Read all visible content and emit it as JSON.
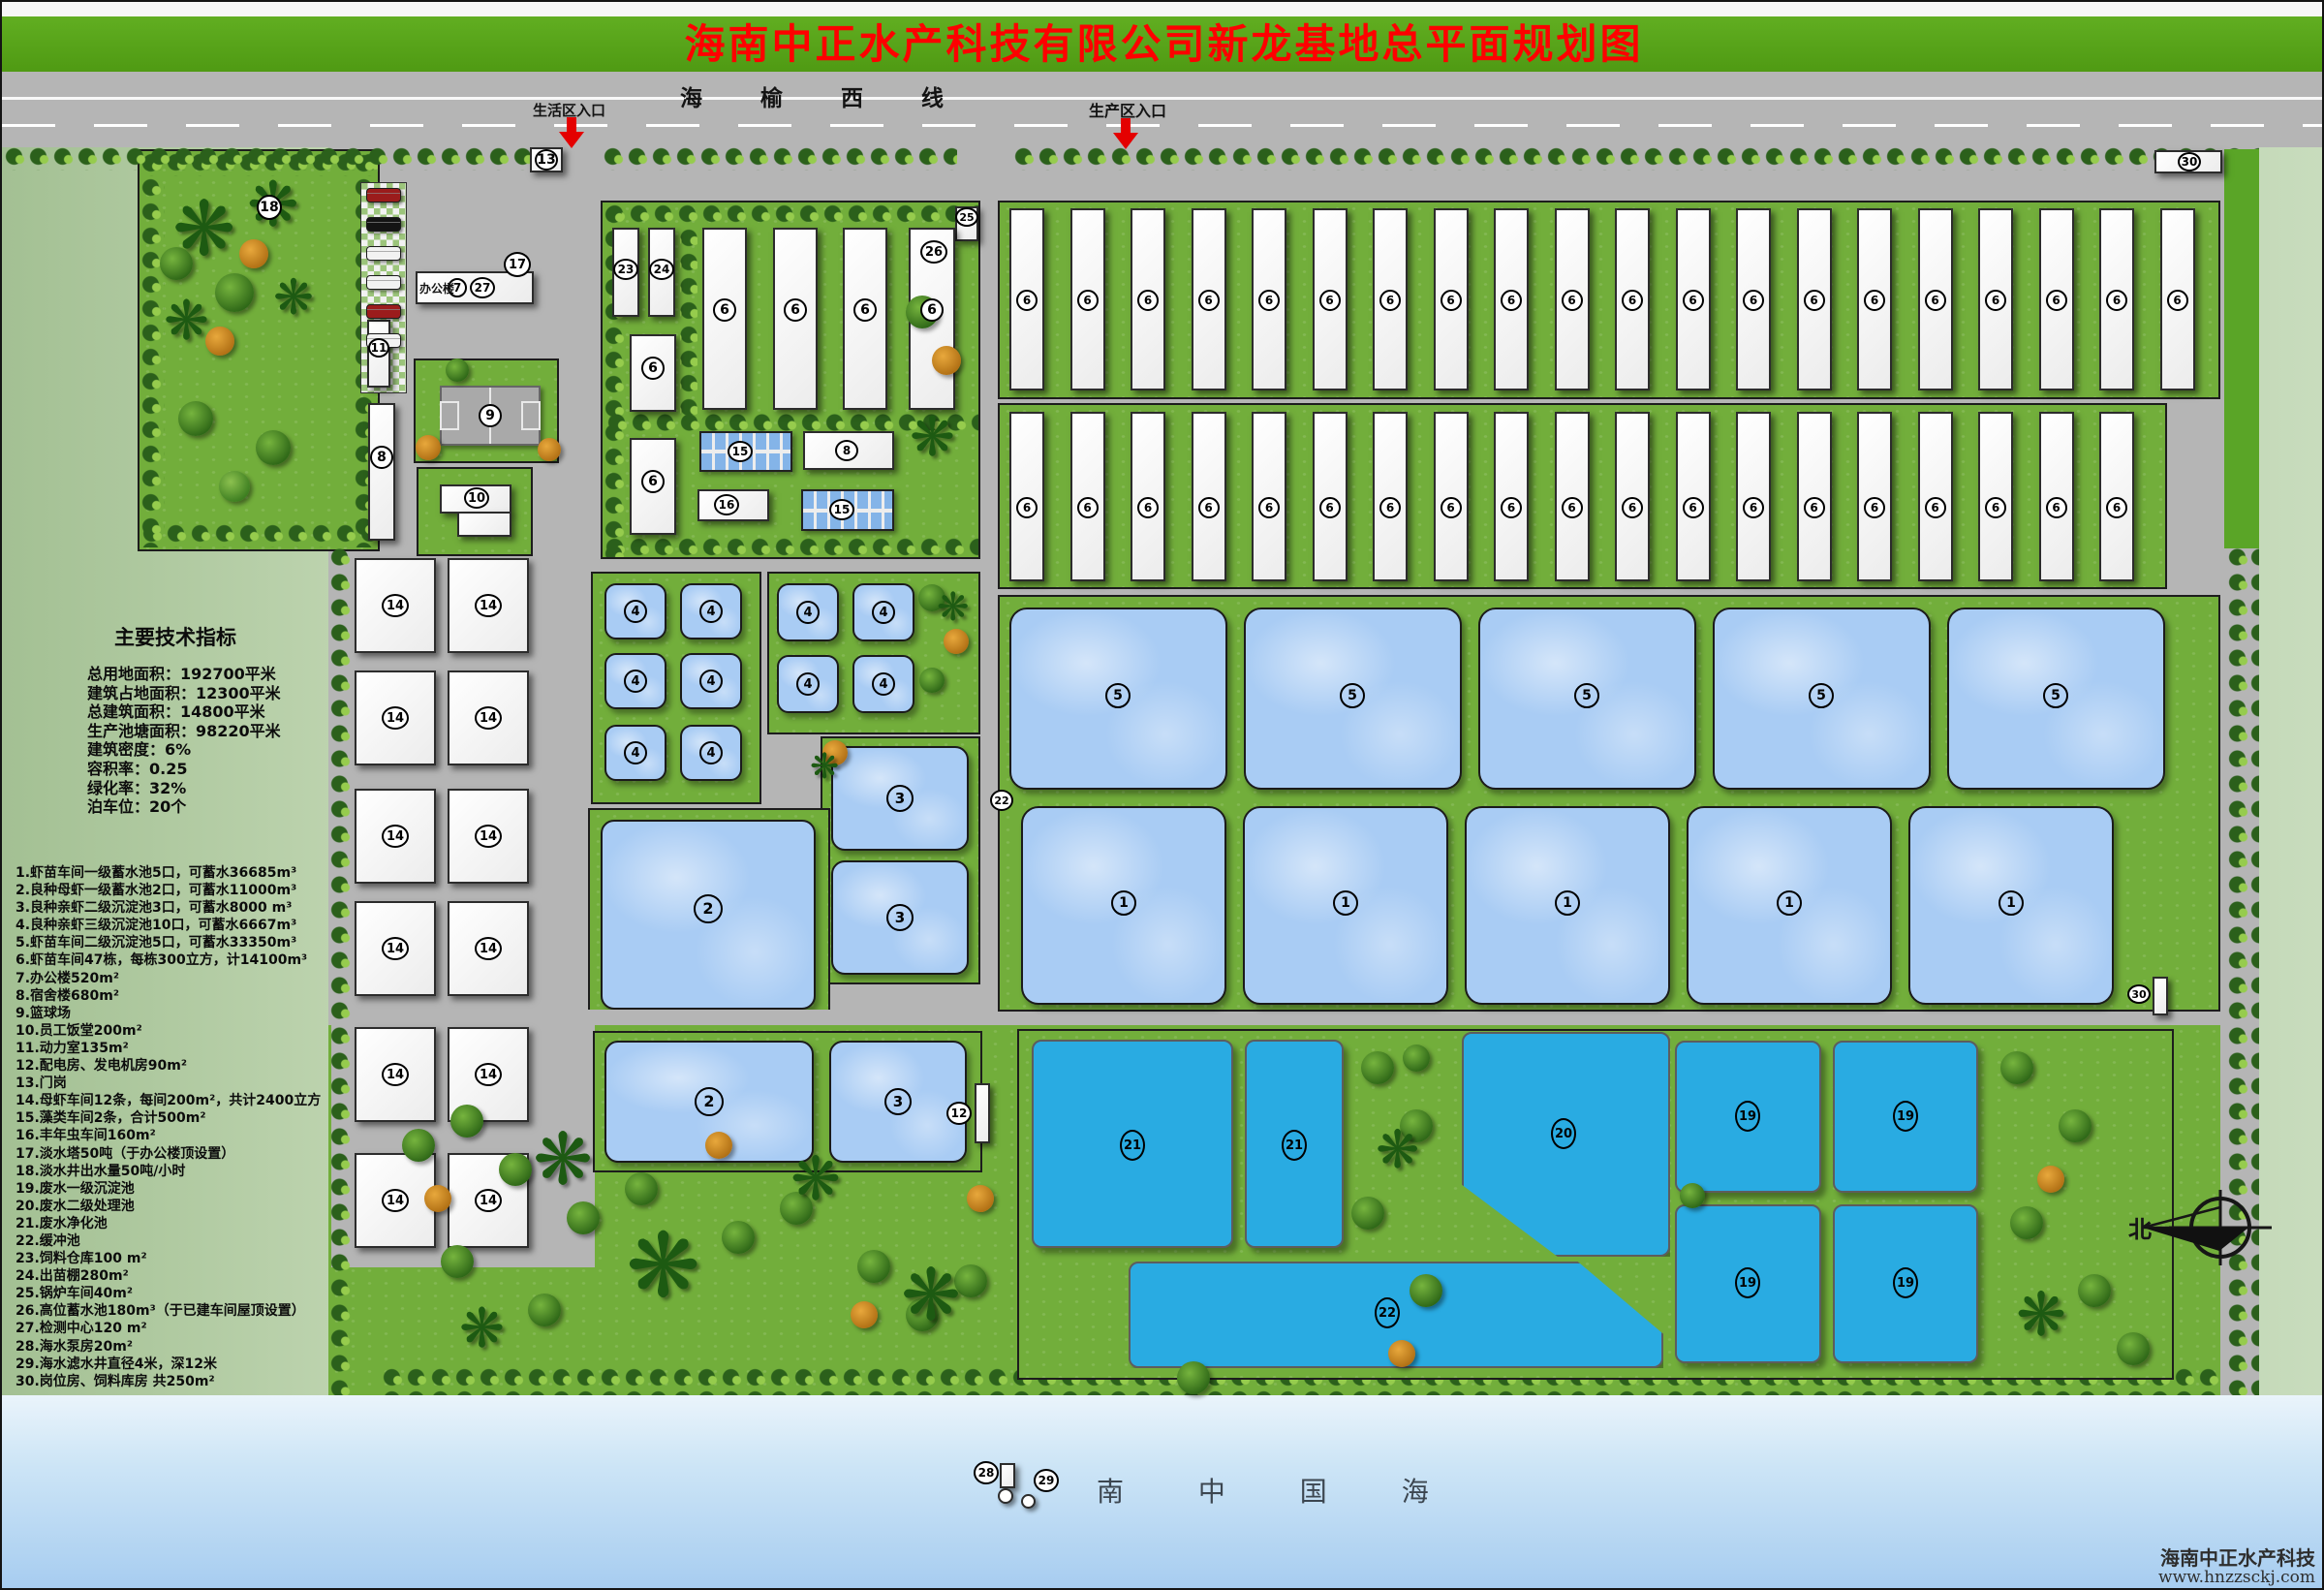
{
  "title": "海南中正水产科技有限公司新龙基地总平面规划图",
  "road": {
    "name": "海 榆 西 线",
    "entrance_residential": "生活区入口",
    "entrance_production": "生产区入口"
  },
  "indicators": {
    "heading": "主要技术指标",
    "lines": [
      "总用地面积：192700平米",
      "建筑占地面积：12300平米",
      "总建筑面积：14800平米",
      "生产池塘面积：98220平米",
      "建筑密度：6%",
      "容积率：0.25",
      "绿化率：32%",
      "泊车位：20个"
    ]
  },
  "legend": [
    "1.虾苗车间一级蓄水池5口，可蓄水36685m³",
    "2.良种母虾一级蓄水池2口，可蓄水11000m³",
    "3.良种亲虾二级沉淀池3口，可蓄水8000 m³",
    "4.良种亲虾三级沉淀池10口，可蓄水6667m³",
    "5.虾苗车间二级沉淀池5口，可蓄水33350m³",
    "6.虾苗车间47栋，每栋300立方，计14100m³",
    "7.办公楼520m²",
    "8.宿舍楼680m²",
    "9.篮球场",
    "10.员工饭堂200m²",
    "11.动力室135m²",
    "12.配电房、发电机房90m²",
    "13.门岗",
    "14.母虾车间12条，每间200m²，共计2400立方",
    "15.藻类车间2条，合计500m²",
    "16.丰年虫车间160m²",
    "17.淡水塔50吨（于办公楼顶设置）",
    "18.淡水井出水量50吨/小时",
    "19.废水一级沉淀池",
    "20.废水二级处理池",
    "21.废水净化池",
    "22.缓冲池",
    "23.饲料仓库100 m²",
    "24.出苗棚280m²",
    "25.锅炉车间40m²",
    "26.高位蓄水池180m³（于已建车间屋顶设置）",
    "27.检测中心120 m²",
    "28.海水泵房20m²",
    "29.海水滤水井直径4米，深12米",
    "30.岗位房、饲料库房 共250m²"
  ],
  "labels": {
    "office": "办公楼"
  },
  "sea": {
    "name": "南  中  国  海"
  },
  "compass": {
    "north": "北"
  },
  "watermark": {
    "line1": "海南中正水产科技",
    "line2": "www.hnzzsckj.com"
  },
  "icons": {
    "palm": "❋"
  },
  "markers": {
    "1": "1",
    "2": "2",
    "3": "3",
    "4": "4",
    "5": "5",
    "6": "6",
    "7": "7",
    "8": "8",
    "9": "9",
    "10": "10",
    "11": "11",
    "12": "12",
    "13": "13",
    "14": "14",
    "15": "15",
    "16": "16",
    "17": "17",
    "18": "18",
    "19": "19",
    "20": "20",
    "21": "21",
    "22": "22",
    "23": "23",
    "24": "24",
    "25": "25",
    "26": "26",
    "27": "27",
    "28": "28",
    "29": "29",
    "30": "30"
  },
  "colors": {
    "title_bar": "#58a51b",
    "title_text": "#ff0000",
    "road": "#b5b5b5",
    "grass": "#72ae3b",
    "pond_light": "#a9ccf4",
    "pond_deep": "#29abe2",
    "building": "#f3f3f3",
    "sea_top": "#eaf4fb",
    "sea_bottom": "#a6ccf0"
  }
}
